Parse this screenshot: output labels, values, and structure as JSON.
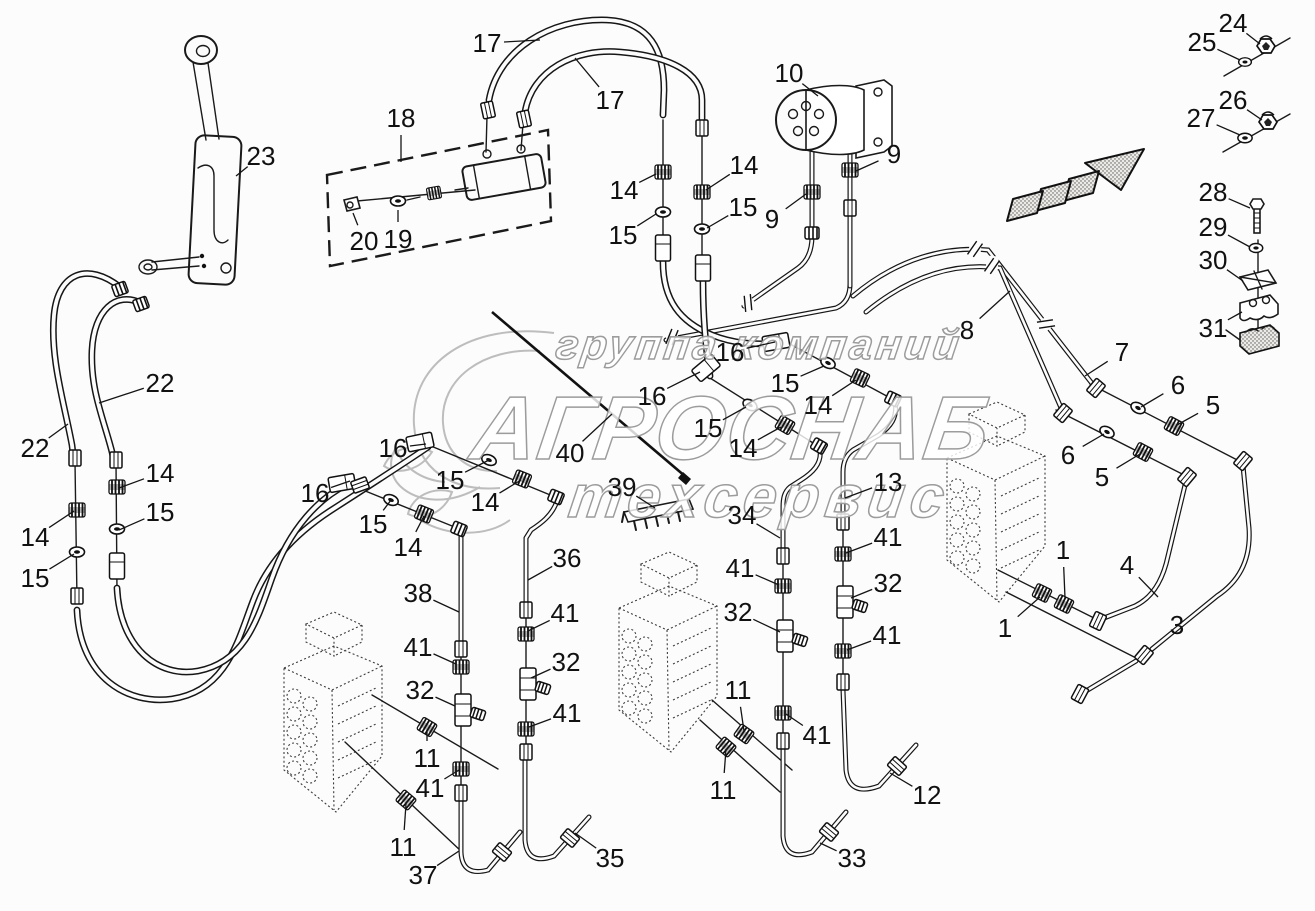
{
  "watermark": {
    "line1": "группа компаний",
    "line2": "АГРОСНАБ",
    "line3": "техсервис"
  },
  "callouts": [
    {
      "label": "23",
      "x": 261,
      "y": 156,
      "tx": 236,
      "ty": 176
    },
    {
      "label": "17",
      "x": 487,
      "y": 43,
      "tx": 540,
      "ty": 40
    },
    {
      "label": "17",
      "x": 610,
      "y": 100,
      "tx": 575,
      "ty": 58
    },
    {
      "label": "18",
      "x": 401,
      "y": 118,
      "tx": 401,
      "ty": 162
    },
    {
      "label": "20",
      "x": 364,
      "y": 241,
      "tx": 353,
      "ty": 213
    },
    {
      "label": "19",
      "x": 398,
      "y": 239,
      "tx": 398,
      "ty": 210
    },
    {
      "label": "10",
      "x": 789,
      "y": 73,
      "tx": 818,
      "ty": 96
    },
    {
      "label": "9",
      "x": 894,
      "y": 154,
      "tx": 856,
      "ty": 171
    },
    {
      "label": "9",
      "x": 772,
      "y": 219,
      "tx": 806,
      "ty": 194
    },
    {
      "label": "14",
      "x": 624,
      "y": 190,
      "tx": 656,
      "ty": 174
    },
    {
      "label": "15",
      "x": 623,
      "y": 235,
      "tx": 656,
      "ty": 214
    },
    {
      "label": "14",
      "x": 744,
      "y": 165,
      "tx": 706,
      "ty": 190
    },
    {
      "label": "15",
      "x": 743,
      "y": 207,
      "tx": 707,
      "ty": 228
    },
    {
      "label": "24",
      "x": 1233,
      "y": 23,
      "tx": 1260,
      "ty": 44
    },
    {
      "label": "25",
      "x": 1202,
      "y": 42,
      "tx": 1240,
      "ty": 60
    },
    {
      "label": "26",
      "x": 1233,
      "y": 100,
      "tx": 1262,
      "ty": 120
    },
    {
      "label": "27",
      "x": 1201,
      "y": 118,
      "tx": 1240,
      "ty": 135
    },
    {
      "label": "28",
      "x": 1213,
      "y": 192,
      "tx": 1250,
      "ty": 208
    },
    {
      "label": "29",
      "x": 1213,
      "y": 227,
      "tx": 1250,
      "ty": 247
    },
    {
      "label": "30",
      "x": 1213,
      "y": 260,
      "tx": 1243,
      "ty": 281
    },
    {
      "label": "31",
      "x": 1213,
      "y": 328,
      "tx": 1242,
      "ty": 312
    },
    {
      "label": "8",
      "x": 967,
      "y": 330,
      "tx": 1010,
      "ty": 291
    },
    {
      "label": "7",
      "x": 1122,
      "y": 352,
      "tx": 1085,
      "ty": 376
    },
    {
      "label": "6",
      "x": 1178,
      "y": 385,
      "tx": 1141,
      "ty": 407
    },
    {
      "label": "5",
      "x": 1213,
      "y": 405,
      "tx": 1177,
      "ty": 425
    },
    {
      "label": "6",
      "x": 1068,
      "y": 455,
      "tx": 1104,
      "ty": 434
    },
    {
      "label": "5",
      "x": 1102,
      "y": 477,
      "tx": 1140,
      "ty": 454
    },
    {
      "label": "1",
      "x": 1063,
      "y": 550,
      "tx": 1065,
      "ty": 598
    },
    {
      "label": "4",
      "x": 1127,
      "y": 565,
      "tx": 1158,
      "ty": 597
    },
    {
      "label": "1",
      "x": 1005,
      "y": 628,
      "tx": 1040,
      "ty": 597
    },
    {
      "label": "3",
      "x": 1177,
      "y": 625,
      "tx": 1192,
      "ty": 618
    },
    {
      "label": "16",
      "x": 730,
      "y": 352,
      "tx": 775,
      "ty": 342
    },
    {
      "label": "16",
      "x": 652,
      "y": 396,
      "tx": 700,
      "ty": 372
    },
    {
      "label": "15",
      "x": 785,
      "y": 383,
      "tx": 824,
      "ty": 366
    },
    {
      "label": "14",
      "x": 818,
      "y": 405,
      "tx": 856,
      "ty": 380
    },
    {
      "label": "15",
      "x": 708,
      "y": 428,
      "tx": 746,
      "ty": 407
    },
    {
      "label": "14",
      "x": 743,
      "y": 448,
      "tx": 781,
      "ty": 427
    },
    {
      "label": "13",
      "x": 888,
      "y": 482,
      "tx": 845,
      "ty": 498
    },
    {
      "label": "40",
      "x": 570,
      "y": 453,
      "tx": 612,
      "ty": 414
    },
    {
      "label": "39",
      "x": 622,
      "y": 487,
      "tx": 655,
      "ty": 508
    },
    {
      "label": "34",
      "x": 742,
      "y": 515,
      "tx": 780,
      "ty": 538
    },
    {
      "label": "22",
      "x": 160,
      "y": 383,
      "tx": 99,
      "ty": 403
    },
    {
      "label": "22",
      "x": 35,
      "y": 448,
      "tx": 68,
      "ty": 424
    },
    {
      "label": "14",
      "x": 160,
      "y": 473,
      "tx": 119,
      "ty": 488
    },
    {
      "label": "15",
      "x": 160,
      "y": 512,
      "tx": 119,
      "ty": 530
    },
    {
      "label": "14",
      "x": 35,
      "y": 537,
      "tx": 74,
      "ty": 511
    },
    {
      "label": "15",
      "x": 35,
      "y": 578,
      "tx": 74,
      "ty": 554
    },
    {
      "label": "16",
      "x": 315,
      "y": 493,
      "tx": 350,
      "ty": 481
    },
    {
      "label": "16",
      "x": 393,
      "y": 448,
      "tx": 426,
      "ty": 444
    },
    {
      "label": "15",
      "x": 373,
      "y": 524,
      "tx": 391,
      "ty": 500
    },
    {
      "label": "14",
      "x": 408,
      "y": 547,
      "tx": 424,
      "ty": 516
    },
    {
      "label": "15",
      "x": 450,
      "y": 480,
      "tx": 489,
      "ty": 460
    },
    {
      "label": "14",
      "x": 485,
      "y": 502,
      "tx": 521,
      "ty": 480
    },
    {
      "label": "38",
      "x": 418,
      "y": 593,
      "tx": 459,
      "ty": 612
    },
    {
      "label": "36",
      "x": 567,
      "y": 558,
      "tx": 528,
      "ty": 580
    },
    {
      "label": "41",
      "x": 418,
      "y": 647,
      "tx": 456,
      "ty": 664
    },
    {
      "label": "32",
      "x": 420,
      "y": 690,
      "tx": 455,
      "ty": 706
    },
    {
      "label": "11",
      "x": 427,
      "y": 758,
      "tx": 427,
      "ty": 730
    },
    {
      "label": "41",
      "x": 430,
      "y": 788,
      "tx": 459,
      "ty": 770
    },
    {
      "label": "11",
      "x": 403,
      "y": 847,
      "tx": 406,
      "ty": 804
    },
    {
      "label": "37",
      "x": 423,
      "y": 875,
      "tx": 459,
      "ty": 851
    },
    {
      "label": "41",
      "x": 565,
      "y": 613,
      "tx": 528,
      "ty": 631
    },
    {
      "label": "32",
      "x": 566,
      "y": 662,
      "tx": 531,
      "ty": 678
    },
    {
      "label": "41",
      "x": 567,
      "y": 713,
      "tx": 529,
      "ty": 727
    },
    {
      "label": "35",
      "x": 610,
      "y": 858,
      "tx": 575,
      "ty": 833
    },
    {
      "label": "41",
      "x": 740,
      "y": 568,
      "tx": 779,
      "ty": 585
    },
    {
      "label": "32",
      "x": 738,
      "y": 612,
      "tx": 780,
      "ty": 632
    },
    {
      "label": "11",
      "x": 738,
      "y": 690,
      "tx": 744,
      "ty": 731
    },
    {
      "label": "11",
      "x": 723,
      "y": 790,
      "tx": 726,
      "ty": 749
    },
    {
      "label": "41",
      "x": 817,
      "y": 735,
      "tx": 786,
      "ty": 714
    },
    {
      "label": "33",
      "x": 852,
      "y": 858,
      "tx": 820,
      "ty": 843
    },
    {
      "label": "41",
      "x": 888,
      "y": 537,
      "tx": 846,
      "ty": 553
    },
    {
      "label": "32",
      "x": 888,
      "y": 583,
      "tx": 851,
      "ty": 598
    },
    {
      "label": "41",
      "x": 887,
      "y": 635,
      "tx": 847,
      "ty": 650
    },
    {
      "label": "12",
      "x": 927,
      "y": 795,
      "tx": 890,
      "ty": 773
    }
  ]
}
